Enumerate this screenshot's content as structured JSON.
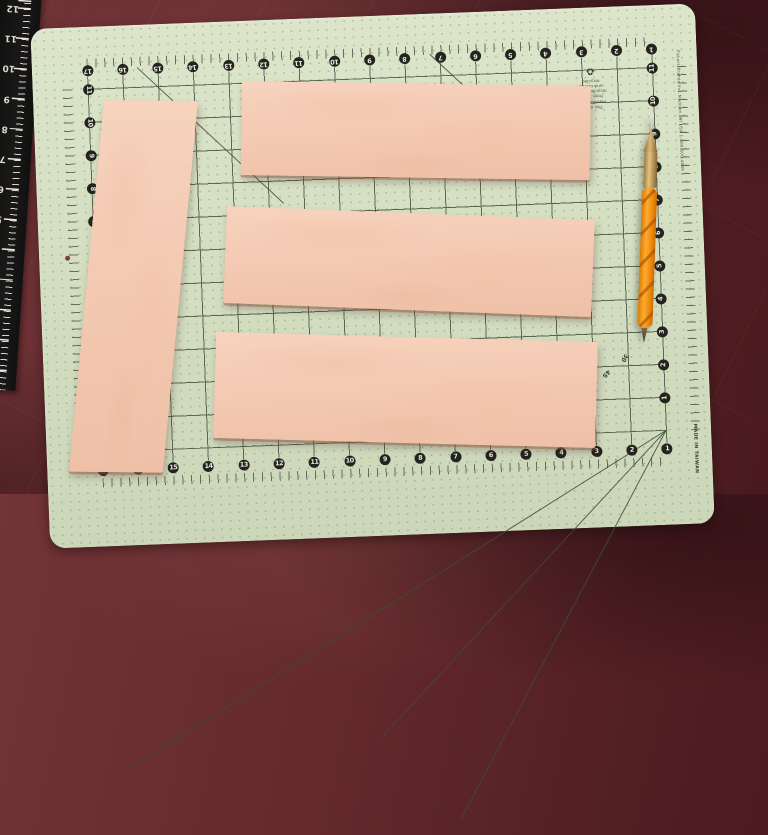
{
  "scene": {
    "leather_strips_count": 4,
    "colors": {
      "table_surface": "#5f282c",
      "mat": "#d4dfc2",
      "mat_grid_line": "#46533f",
      "number_chip": "#23231f",
      "leather": "#f3c8b0",
      "ruler_body": "#141414",
      "tool_grip": "#f79a1f",
      "tool_ferrule": "#c79b58"
    }
  },
  "mat": {
    "numbers_top": [
      "17",
      "16",
      "15",
      "14",
      "13",
      "12",
      "11",
      "10",
      "9",
      "8",
      "7",
      "6",
      "5",
      "4",
      "3",
      "2",
      "1"
    ],
    "numbers_bottom": [
      "17",
      "16",
      "15",
      "14",
      "13",
      "12",
      "11",
      "10",
      "9",
      "8",
      "7",
      "6",
      "5",
      "4",
      "3",
      "2",
      "1"
    ],
    "numbers_left": [
      "11",
      "10",
      "9",
      "8",
      "7",
      "6",
      "5",
      "4",
      "3",
      "2",
      "1"
    ],
    "numbers_right": [
      "11",
      "10",
      "9",
      "8",
      "7",
      "6",
      "5",
      "4",
      "3",
      "2",
      "1"
    ],
    "angle_label_30": "30",
    "angle_label_45": "45",
    "angle_label_60": "60",
    "made_in_text": "MADE IN TAIWAN",
    "recycle_symbol": "♻",
    "recycle_lines": [
      "This mat is manufactured",
      "from 100% recycled paper",
      "and can be recycled"
    ],
    "brand_text": "Fiskars Brands Inc.  Madison, WI  USA   1-800-500-4849"
  },
  "hand_ruler": {
    "numbers": [
      "12",
      "11",
      "10",
      "9",
      "8",
      "7",
      "6",
      "5",
      "4"
    ]
  }
}
